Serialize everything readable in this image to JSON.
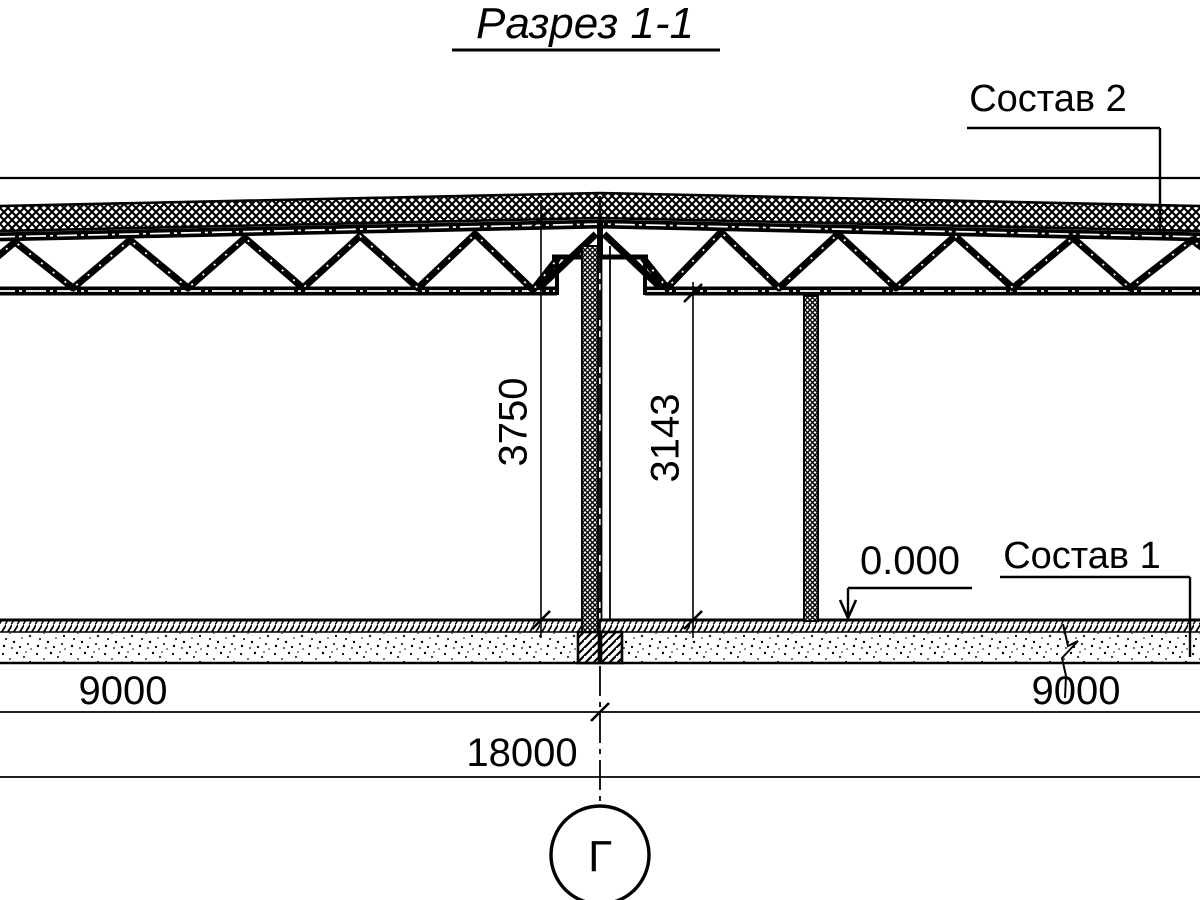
{
  "title": "Разрез 1-1",
  "callouts": {
    "sostav2": "Состав 2",
    "sostav1": "Состав 1"
  },
  "levels": {
    "zero": "0.000"
  },
  "dimensions": {
    "height_total": "3750",
    "height_clear": "3143",
    "span_left": "9000",
    "span_right": "9000",
    "span_total": "18000"
  },
  "axis": {
    "label": "Г"
  },
  "colors": {
    "ink": "#000000",
    "paper": "#ffffff"
  }
}
